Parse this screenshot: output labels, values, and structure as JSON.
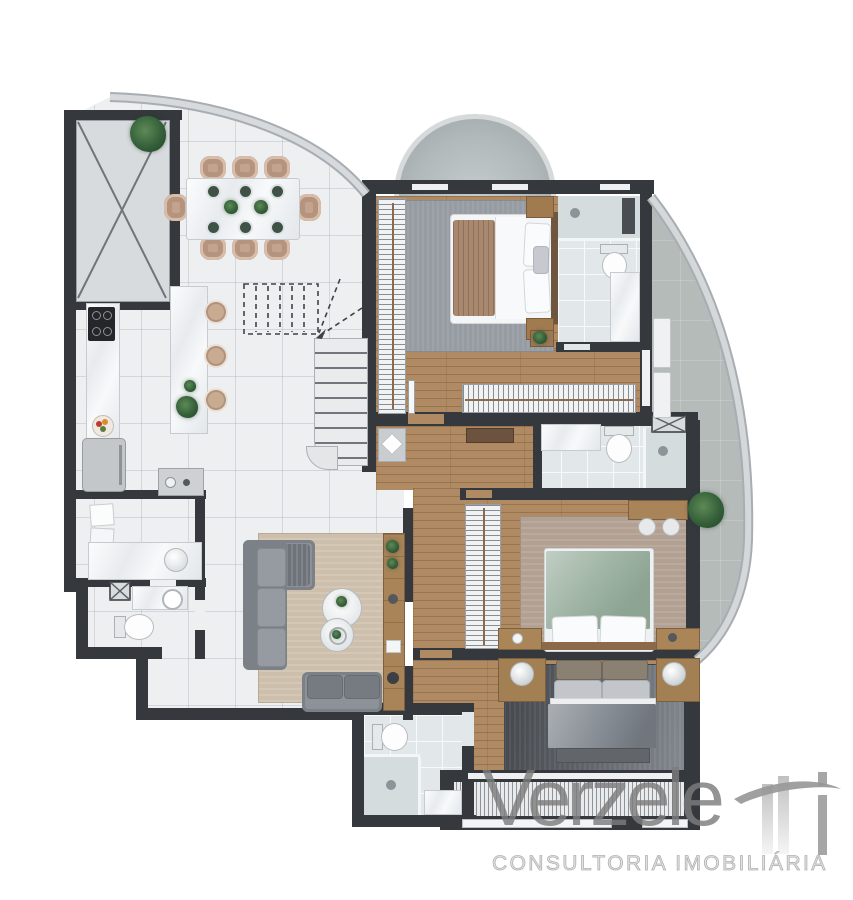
{
  "brand": {
    "wordmark": "Verzele",
    "mark_letters": "tti",
    "tagline": "CONSULTORIA IMOBILIÁRIA",
    "wordmark_color": "#8d8d8d",
    "tagline_color": "#bdbdbd"
  },
  "palette": {
    "wall": "#35393e",
    "social_floor": "#edeff1",
    "wood_floor": "#b08a63",
    "bath_tile": "#e2e8ea",
    "balcony_floor": "#b4bbb9",
    "rug_master": "#979ca3",
    "rug_suite2": "#b2a193",
    "rug_suite3": "#4a4e54",
    "rug_living": "#cdbfac",
    "bed_green": "#9fb4a4",
    "bed_gray": "#8b9198",
    "sofa_gray": "#8d9298",
    "chair_tan": "#c3a38d",
    "plant_green": "#35603a",
    "marble": "#f2f4f5"
  }
}
